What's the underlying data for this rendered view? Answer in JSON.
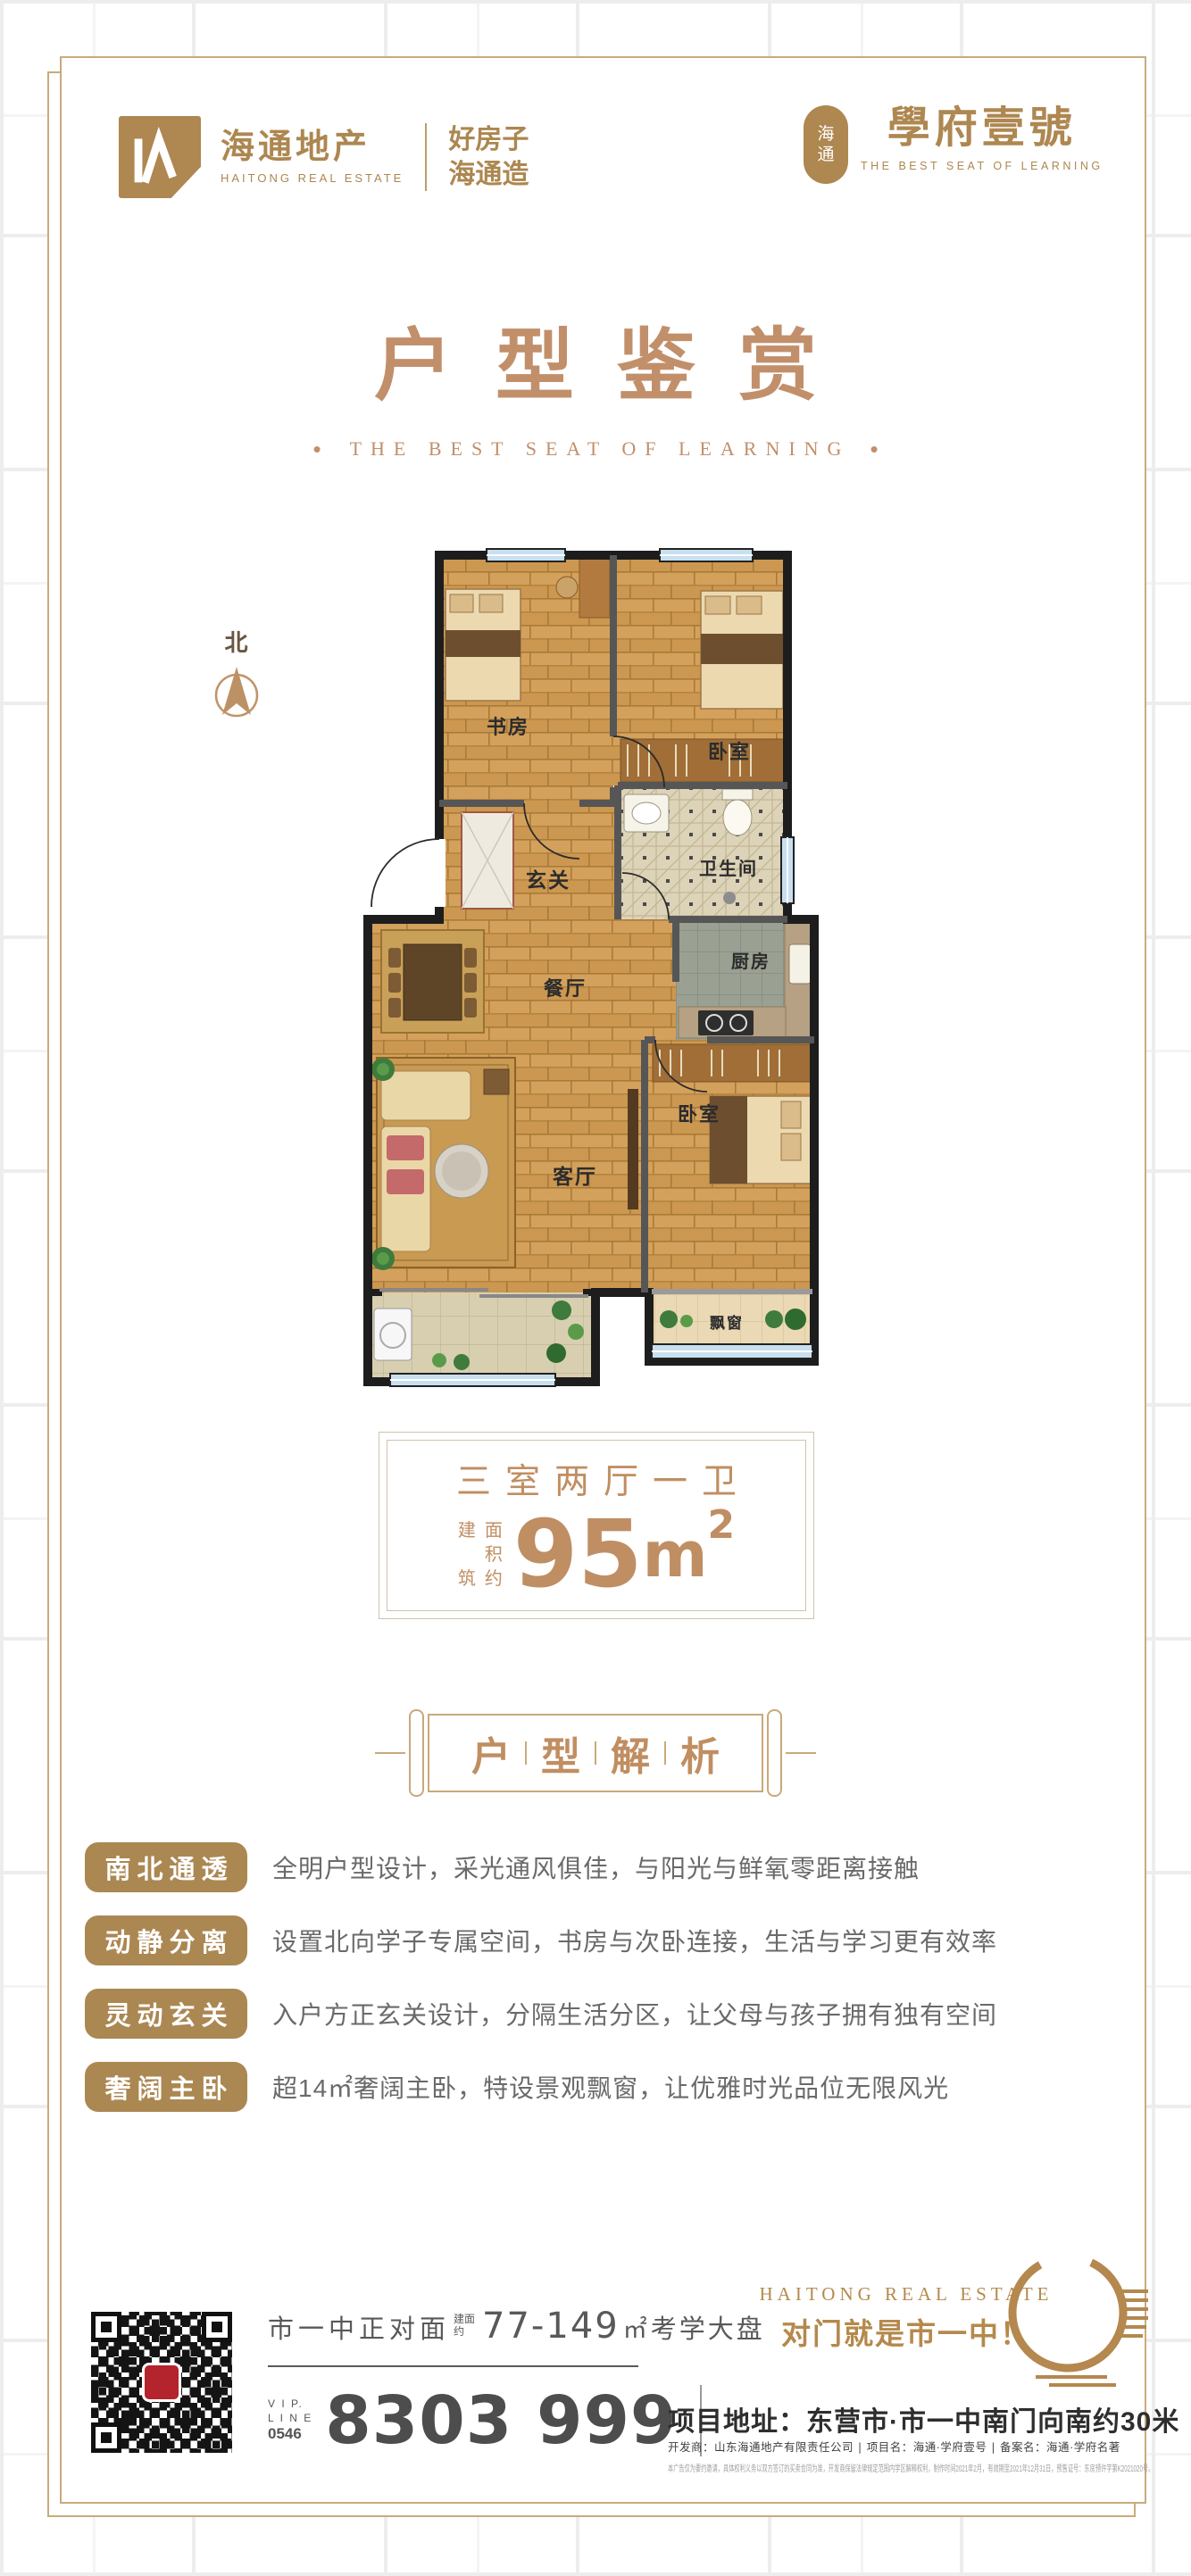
{
  "header": {
    "logo_cn": "海通地产",
    "logo_en": "HAITONG REAL ESTATE",
    "slogan_lines": [
      "好房子",
      "海通造"
    ],
    "seal_chars": [
      "海",
      "通"
    ],
    "project_name": "學府壹號",
    "project_tagline": "THE BEST SEAT OF LEARNING"
  },
  "title": {
    "cn": "户型鉴赏",
    "en": "THE BEST SEAT OF LEARNING",
    "dot": "•"
  },
  "compass": {
    "label": "北"
  },
  "floor_plan": {
    "rooms": [
      "书房",
      "卧室",
      "玄关",
      "卫生间",
      "餐厅",
      "厨房",
      "客厅",
      "卧室",
      "飘窗"
    ]
  },
  "area_box": {
    "layout_type": "三室两厅一卫",
    "prefix_col1": [
      "建",
      "筑"
    ],
    "prefix_col2": [
      "面",
      "积",
      "约"
    ],
    "value": "95",
    "unit": "m",
    "sup": "2"
  },
  "section": {
    "chars": [
      "户",
      "型",
      "解",
      "析"
    ]
  },
  "features": [
    {
      "tag": "南北通透",
      "desc": "全明户型设计，采光通风俱佳，与阳光与鲜氧零距离接触"
    },
    {
      "tag": "动静分离",
      "desc": "设置北向学子专属空间，书房与次卧连接，生活与学习更有效率"
    },
    {
      "tag": "灵动玄关",
      "desc": "入户方正玄关设计，分隔生活分区，让父母与孩子拥有独有空间"
    },
    {
      "tag": "奢阔主卧",
      "desc": "超14㎡奢阔主卧，特设景观飘窗，让优雅时光品位无限风光"
    }
  ],
  "footer": {
    "headline_location": "市一中正对面",
    "headline_prefix_lines": [
      "建面",
      "约"
    ],
    "headline_range": "77-149",
    "headline_unit": "㎡",
    "headline_suffix": "考学大盘",
    "vip_lines": [
      "V I P.",
      "L I N E",
      "0546"
    ],
    "phone": "8303 999",
    "brand_en": "HAITONG REAL ESTATE",
    "brand_slogan": "对门就是市一中！",
    "address_label": "项目地址：",
    "address": "东营市·市一中南门向南约30米",
    "developer_line": "开发商：山东海通地产有限责任公司 ∣ 项目名：海通·学府壹号 ∣ 备案名：海通·学府名著",
    "disclaimer": "本广告仅为要约邀请，具体权利义务以双方签订的买卖合同为准，开发商保留法律规定范围内学区解释权利，制作时间2021年2月，有效期至2021年12月31日，预售证号：东房预许字第K2021020号。"
  },
  "colors": {
    "brand_gold": "#ad8750",
    "title_rose": "#c28f6b",
    "badge_gold": "#ab8752",
    "frame_gold": "#c9aa7d",
    "wall_black": "#1d1d1d",
    "window_blue": "#c8dff0",
    "wood": "#cc9750"
  }
}
